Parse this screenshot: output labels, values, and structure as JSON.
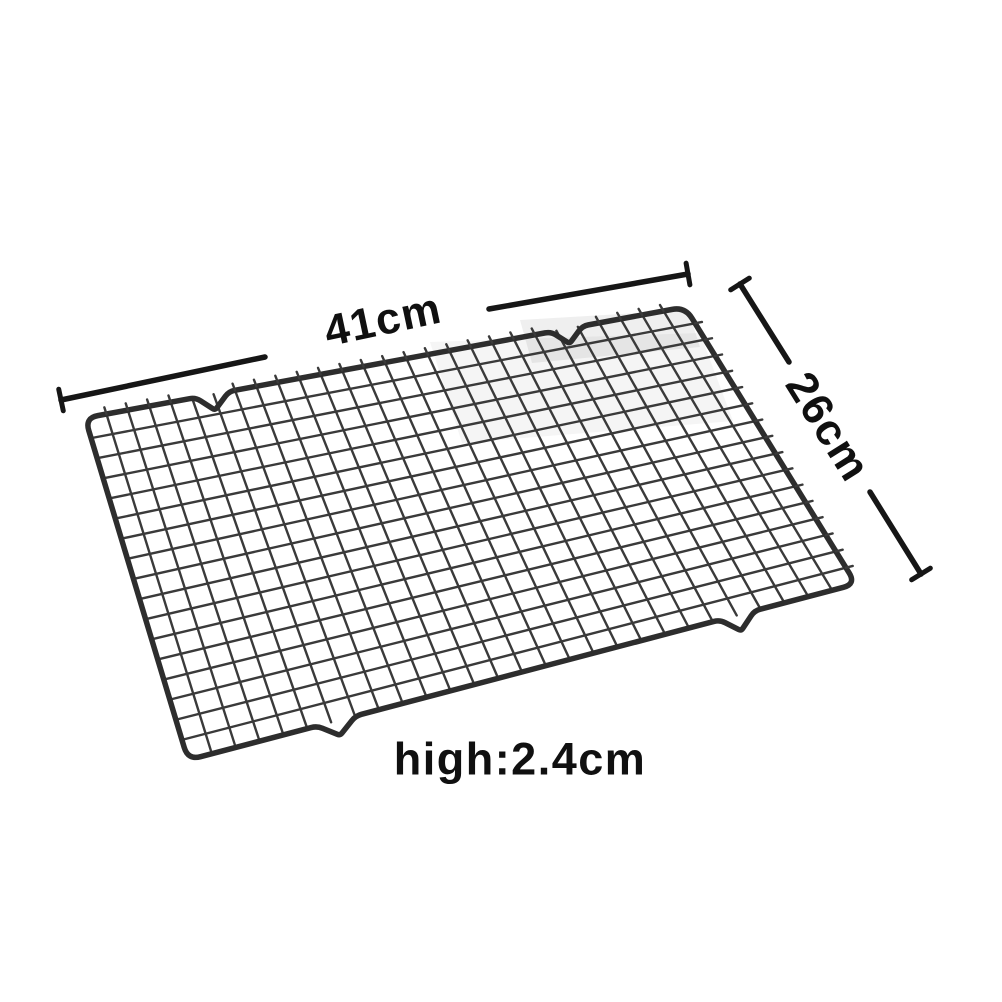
{
  "diagram": {
    "type": "product-dimension-photo",
    "subject": "wire cooling rack",
    "labels": {
      "width": {
        "text": "41cm",
        "x": 383,
        "y": 320,
        "rotation": -12,
        "size": 44
      },
      "depth": {
        "text": "26cm",
        "x": 828,
        "y": 427,
        "rotation": 58,
        "size": 44
      },
      "height": {
        "text": "high:2.4cm",
        "x": 520,
        "y": 759,
        "rotation": 0,
        "size": 45
      }
    },
    "colors": {
      "background": "#ffffff",
      "wire": "#3a3a3a",
      "frame": "#2d2d2d",
      "dimension_line": "#161616",
      "text": "#101010",
      "shading": "#1a1a1a"
    },
    "geometry": {
      "corners": {
        "tl": [
          85,
          418
        ],
        "tr": [
          685,
          307
        ],
        "br": [
          856,
          584
        ],
        "bl": [
          188,
          760
        ]
      },
      "grid": {
        "cols": 28,
        "rows": 17
      },
      "notches": {
        "top": [
          {
            "t": 0.212,
            "hw": 17,
            "d": 16
          },
          {
            "t": 0.803,
            "hw": 16,
            "d": 15
          }
        ],
        "bottom": [
          {
            "t": 0.222,
            "hw": 20,
            "d": 15
          },
          {
            "t": 0.822,
            "hw": 18,
            "d": 16
          }
        ]
      },
      "stub_len": 7,
      "wire_width": 2.4,
      "frame_width": 5.5,
      "corner_radius": 13,
      "dimension_lines": [
        {
          "x1": 61,
          "y1": 400,
          "x2": 265,
          "y2": 357,
          "tick": "start"
        },
        {
          "x1": 489,
          "y1": 309,
          "x2": 688,
          "y2": 274,
          "tick": "end"
        },
        {
          "x1": 740,
          "y1": 284,
          "x2": 789,
          "y2": 362,
          "tick": "start"
        },
        {
          "x1": 870,
          "y1": 492,
          "x2": 921,
          "y2": 574,
          "tick": "end"
        }
      ],
      "dimension_width": 5.5,
      "tick_half": 11,
      "shading": [
        {
          "pts": [
            [
              520,
              320
            ],
            [
              688,
              310
            ],
            [
              700,
              347
            ],
            [
              532,
              363
            ]
          ],
          "opacity": 0.07
        },
        {
          "pts": [
            [
              430,
              342
            ],
            [
              700,
              333
            ],
            [
              733,
              421
            ],
            [
              462,
              443
            ]
          ],
          "opacity": 0.045
        }
      ]
    }
  }
}
